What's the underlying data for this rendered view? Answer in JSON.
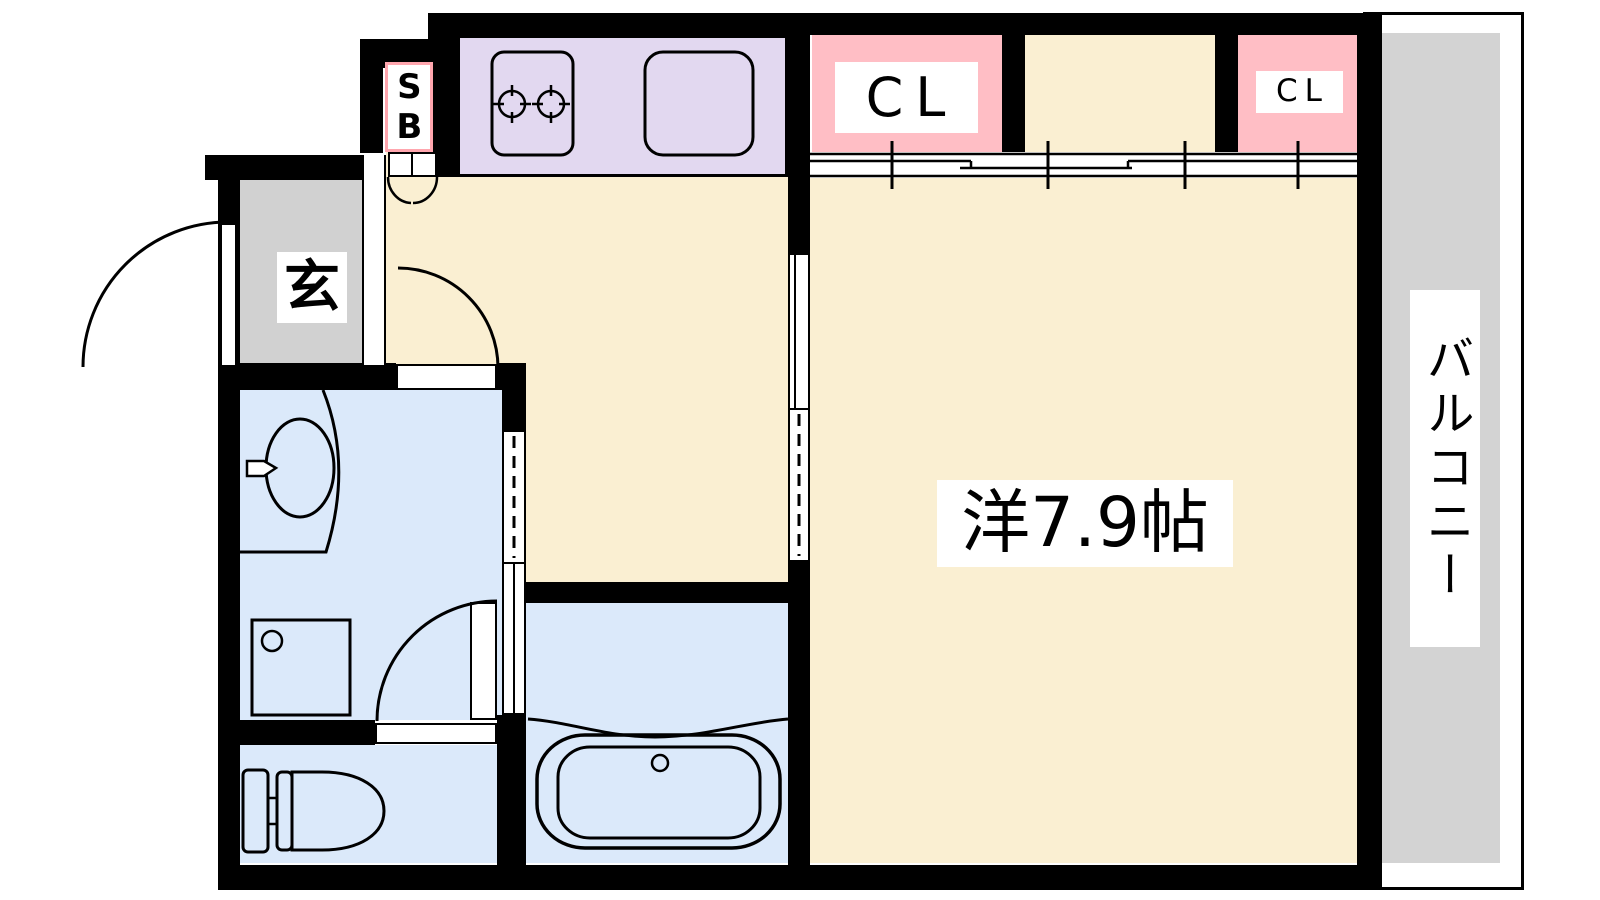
{
  "labels": {
    "shoe_box": "SB",
    "entrance": "玄",
    "closet_main": "CL",
    "closet_small": "CL",
    "western_room": "洋7.9帖",
    "balcony": "バルコニー"
  },
  "colors": {
    "wall": "#000000",
    "flooring": "#faefd2",
    "kitchen_counter": "#e2d8f0",
    "closet": "#ffbec5",
    "wet_area": "#dbe9fa",
    "entrance_floor": "#d1d1d1",
    "balcony_floor": "#d3d3d3",
    "shoe_box_border": "#ffa6ae"
  }
}
